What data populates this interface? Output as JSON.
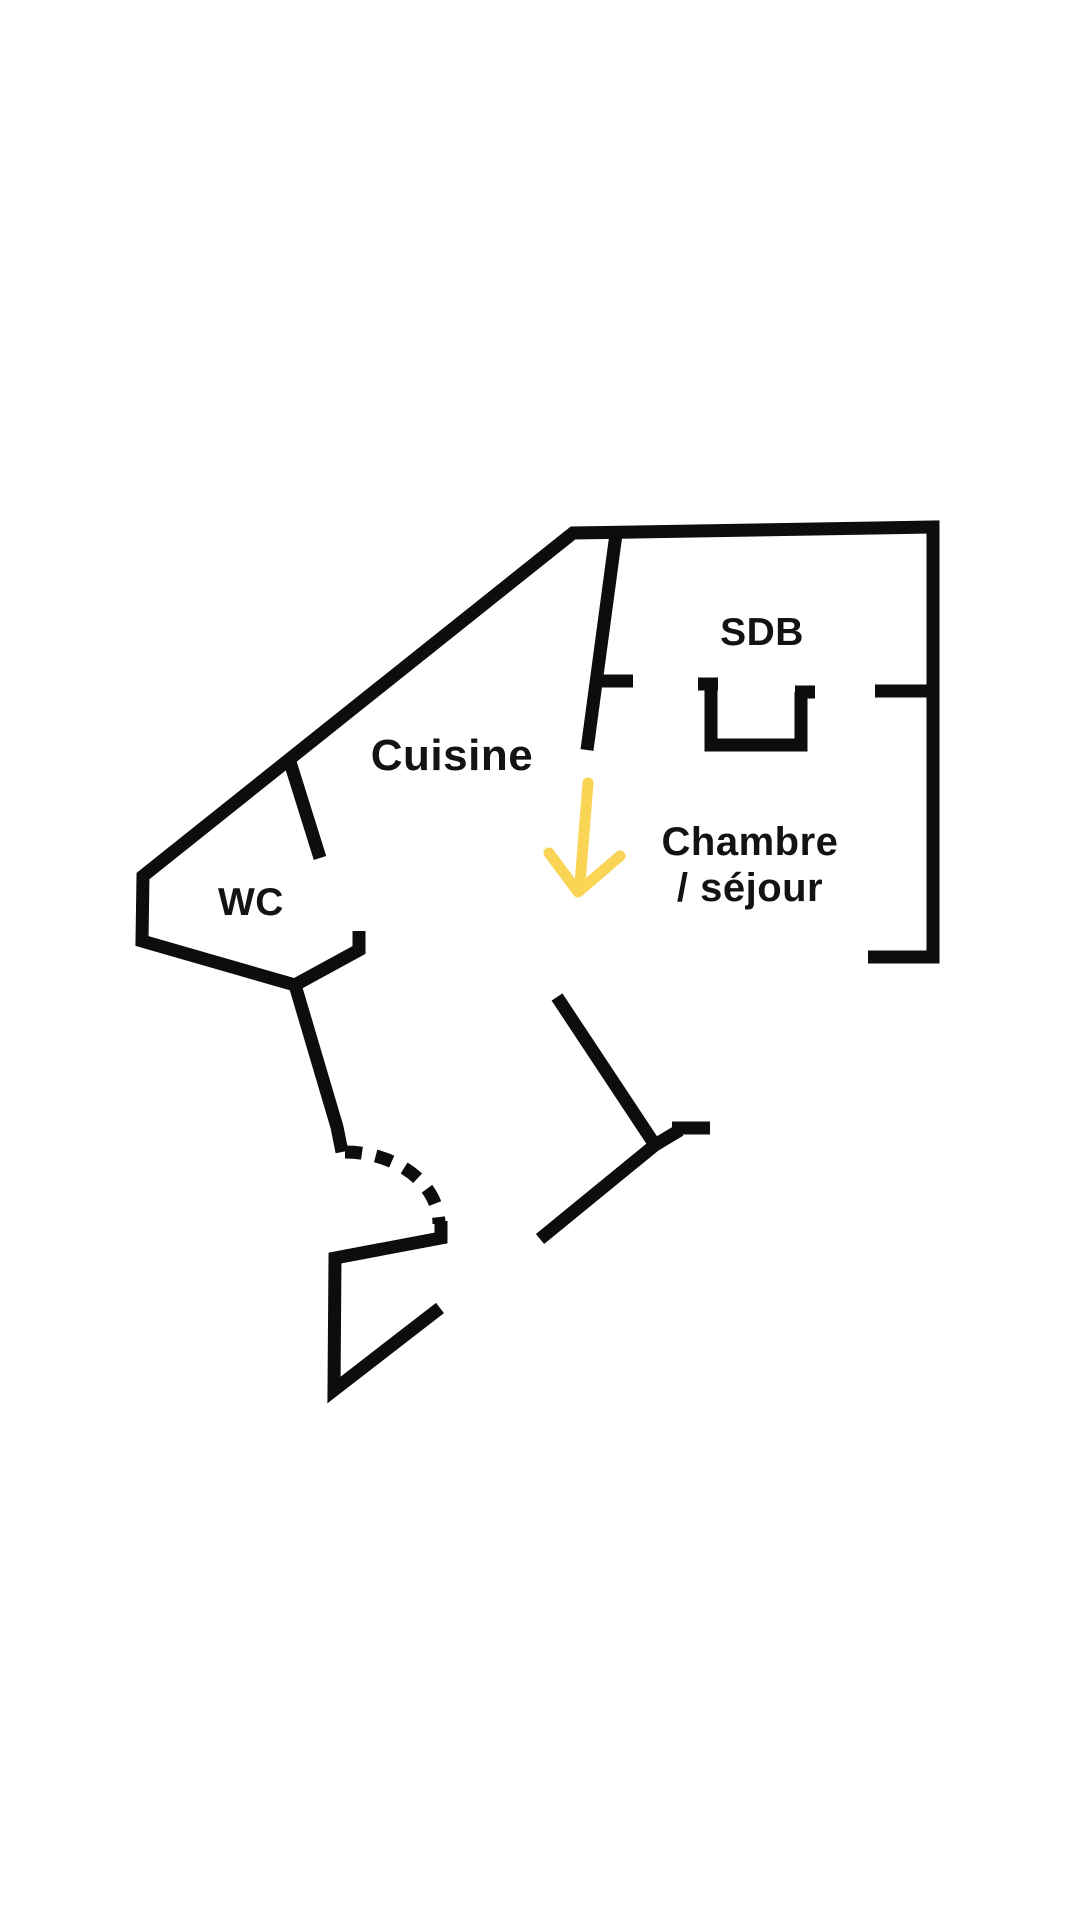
{
  "page": {
    "background": "#ffffff",
    "type_of_drawing": "floor-plan"
  },
  "colors": {
    "wall": "#0d0d0d",
    "label_text": "#131313",
    "arrow": "#fad455"
  },
  "rooms": {
    "sdb": {
      "label": "SDB"
    },
    "cuisine": {
      "label": "Cuisine"
    },
    "wc": {
      "label": "WC"
    },
    "chambre_sejour": {
      "line1": "Chambre",
      "line2": "/ séjour"
    }
  },
  "annotations": {
    "arrow_icon": "down-arrow"
  }
}
